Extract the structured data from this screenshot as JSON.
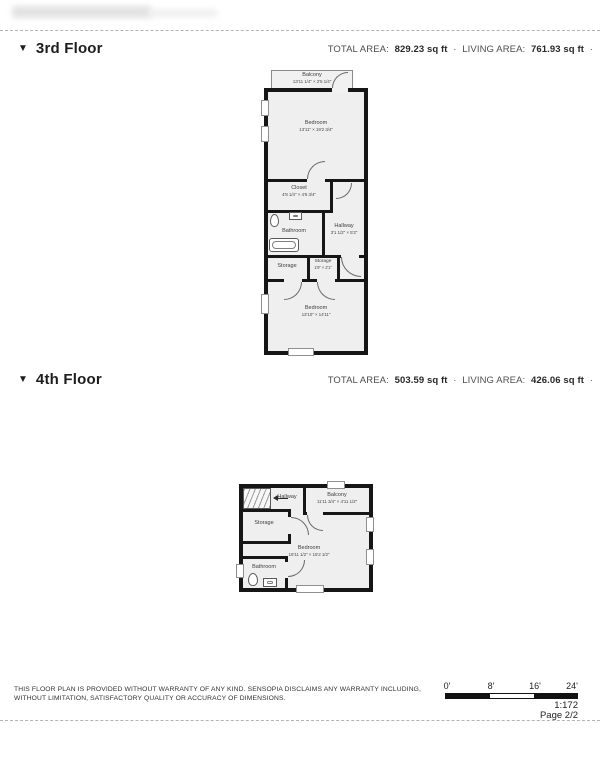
{
  "floors": [
    {
      "marker": "▼",
      "title": "3rd Floor",
      "stats": {
        "total_label": "TOTAL AREA:",
        "total_value": "829.23 sq ft",
        "dot": "·",
        "living_label": "LIVING AREA:",
        "living_value": "761.93 sq ft",
        "trailing_dot": "·"
      },
      "rooms": [
        {
          "name": "Balcony",
          "dims": "13'11 1/4\" × 2'5 1/4\""
        },
        {
          "name": "Bedroom",
          "dims": "13'11\" × 19'2 3/4\""
        },
        {
          "name": "Closet",
          "dims": "4'8 1/4\" × 4'6 3/4\""
        },
        {
          "name": "Bathroom",
          "dims": ""
        },
        {
          "name": "Hallway",
          "dims": "3'1 1/2\" × 5'2\""
        },
        {
          "name": "Storage",
          "dims": ""
        },
        {
          "name": "Storage",
          "dims": "1'9\" × 2'1\""
        },
        {
          "name": "Bedroom",
          "dims": "13'10\" × 14'11\""
        }
      ]
    },
    {
      "marker": "▼",
      "title": "4th Floor",
      "stats": {
        "total_label": "TOTAL AREA:",
        "total_value": "503.59 sq ft",
        "dot": "·",
        "living_label": "LIVING AREA:",
        "living_value": "426.06 sq ft",
        "trailing_dot": "·"
      },
      "rooms": [
        {
          "name": "Hallway",
          "dims": ""
        },
        {
          "name": "Balcony",
          "dims": "11'11 3/4\" × 4'11 1/2\""
        },
        {
          "name": "Storage",
          "dims": ""
        },
        {
          "name": "Bedroom",
          "dims": "16'11 1/2\" × 15'2 1/2\""
        },
        {
          "name": "Bathroom",
          "dims": ""
        }
      ]
    }
  ],
  "footer": {
    "disclaimer_line1": "THIS FLOOR PLAN IS PROVIDED WITHOUT WARRANTY OF ANY KIND. SENSOPIA DISCLAIMS ANY WARRANTY INCLUDING,",
    "disclaimer_line2": "WITHOUT LIMITATION, SATISFACTORY QUALITY OR ACCURACY OF DIMENSIONS.",
    "scale": {
      "tick0": "0'",
      "tick1": "8'",
      "tick2": "16'",
      "tick3": "24'",
      "ratio": "1:172",
      "page": "Page 2/2"
    }
  }
}
